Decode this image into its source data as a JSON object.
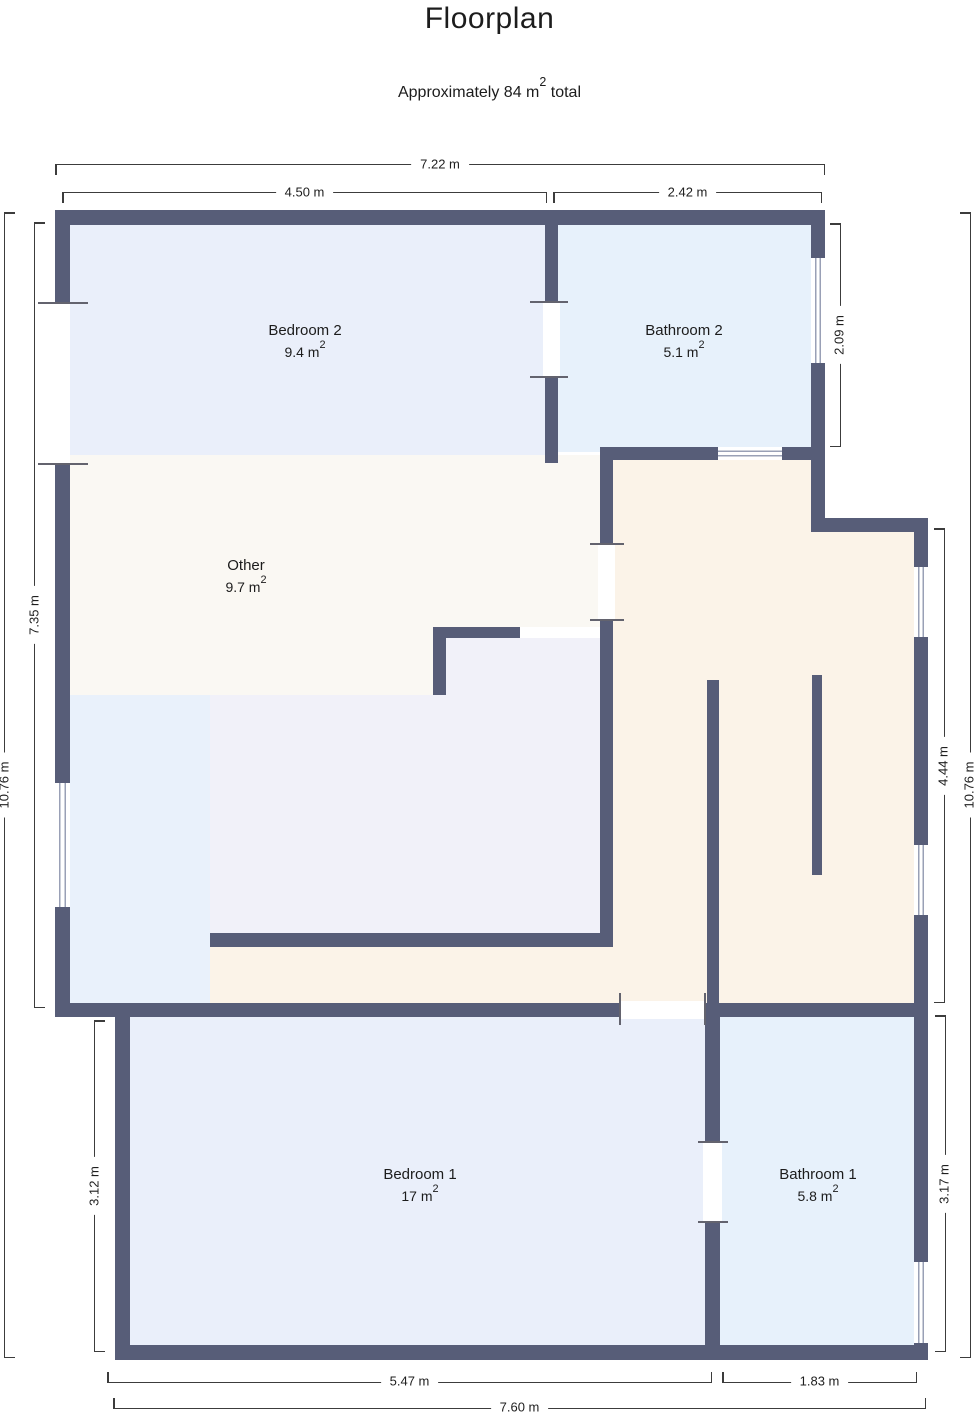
{
  "title": "Floorplan",
  "subtitle": {
    "prefix": "Approximately 84 m",
    "sup": "2",
    "suffix": " total"
  },
  "rooms": [
    {
      "name": "Bedroom 2",
      "area": "9.4 m",
      "sup": "2"
    },
    {
      "name": "Bathroom 2",
      "area": "5.1 m",
      "sup": "2"
    },
    {
      "name": "Other",
      "area": "9.7 m",
      "sup": "2"
    },
    {
      "name": "Bedroom 1",
      "area": "17 m",
      "sup": "2"
    },
    {
      "name": "Bathroom 1",
      "area": "5.8 m",
      "sup": "2"
    }
  ],
  "dimensions": {
    "top_total": "7.22 m",
    "top_bedroom2": "4.50 m",
    "top_bathroom2": "2.42 m",
    "left_total": "10.76 m",
    "left_upper": "7.35 m",
    "left_bedroom1": "3.12 m",
    "right_bathroom2": "2.09 m",
    "right_hallway": "4.44 m",
    "right_total": "10.76 m",
    "right_bathroom1": "3.17 m",
    "bottom_bedroom1": "5.47 m",
    "bottom_bathroom1": "1.83 m",
    "bottom_total": "7.60 m"
  },
  "colors": {
    "wall": "#575d78",
    "bedroom": "#eaeffa",
    "bathroom": "#e7f1fb",
    "other": "#faf8f3",
    "hallway": "#fbf3e8",
    "interior_room": "#f1f1f9",
    "nook": "#e9f1fb"
  }
}
